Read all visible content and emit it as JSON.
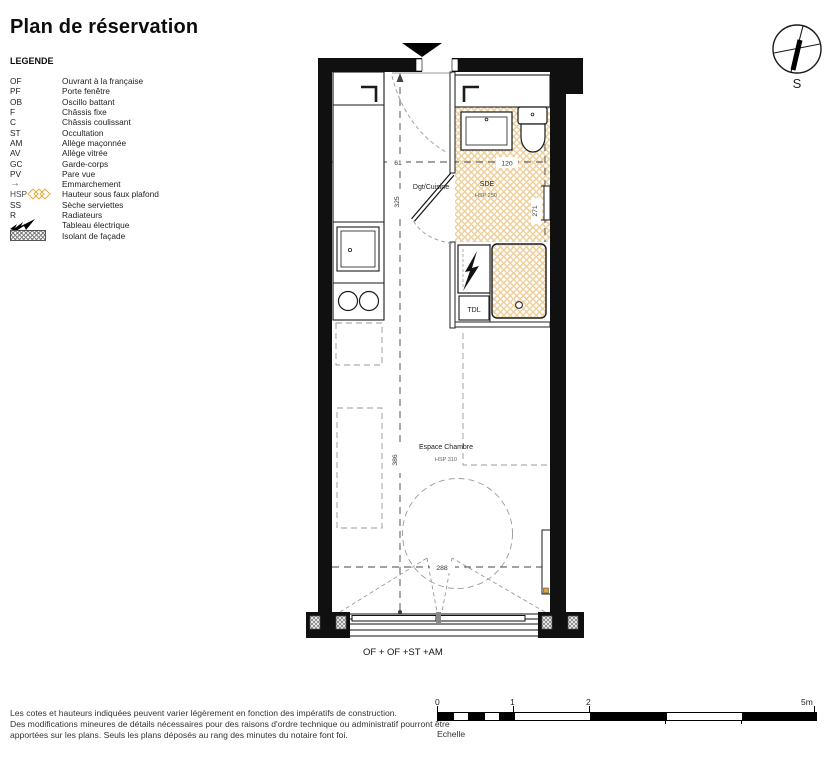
{
  "title": "Plan de réservation",
  "legend": {
    "heading": "LEGENDE",
    "items": [
      {
        "abbr": "OF",
        "label": "Ouvrant à la française"
      },
      {
        "abbr": "PF",
        "label": "Porte fenêtre"
      },
      {
        "abbr": "OB",
        "label": "Oscillo battant"
      },
      {
        "abbr": "F",
        "label": "Châssis fixe"
      },
      {
        "abbr": "C",
        "label": "Châssis coulissant"
      },
      {
        "abbr": "ST",
        "label": "Occultation"
      },
      {
        "abbr": "AM",
        "label": "Allège maçonnée"
      },
      {
        "abbr": "AV",
        "label": "Allège vitrée"
      },
      {
        "abbr": "GC",
        "label": "Garde-corps"
      },
      {
        "abbr": "PV",
        "label": "Pare vue"
      },
      {
        "abbr": "→",
        "label": "Emmarchement"
      },
      {
        "abbr": "HSP",
        "label": "Hauteur sous faux plafond"
      },
      {
        "abbr": "SS",
        "label": "Sèche serviettes"
      },
      {
        "abbr": "R",
        "label": "Radiateurs"
      },
      {
        "abbr": "",
        "label": "Tableau électrique"
      },
      {
        "abbr": "",
        "label": "Isolant de façade"
      }
    ]
  },
  "compass": {
    "south": "S"
  },
  "plan": {
    "rooms": {
      "kitchen": "Dgt/Cuisine",
      "sde": "SDE",
      "sde_hsp": "HSP 250",
      "chambre": "Espace Chambre",
      "chambre_hsp": "HSP 310",
      "tdl": "TDL"
    },
    "dims": {
      "d61": "61",
      "d120": "120",
      "d271": "271",
      "d325": "325",
      "d386": "386",
      "d288": "288"
    },
    "window_label": "OF + OF +ST +AM"
  },
  "scale": {
    "ticks": [
      "0",
      "1",
      "2",
      "5m"
    ],
    "label": "Echelle"
  },
  "footer": {
    "lines": [
      "Les cotes et hauteurs indiquées peuvent varier légèrement en fonction des impératifs de construction.",
      "Des modifications mineures de détails nécessaires pour des raisons d'ordre technique ou administratif pourront être",
      "apportées sur les plans. Seuls les plans déposés au rang des minutes du notaire font foi."
    ]
  },
  "colors": {
    "wall": "#101010",
    "hatch_line": "#eed09c",
    "insulation_gray": "#808080",
    "hsp_diamond": "#e6a93c",
    "radiator_mark": "#e09f3e"
  }
}
